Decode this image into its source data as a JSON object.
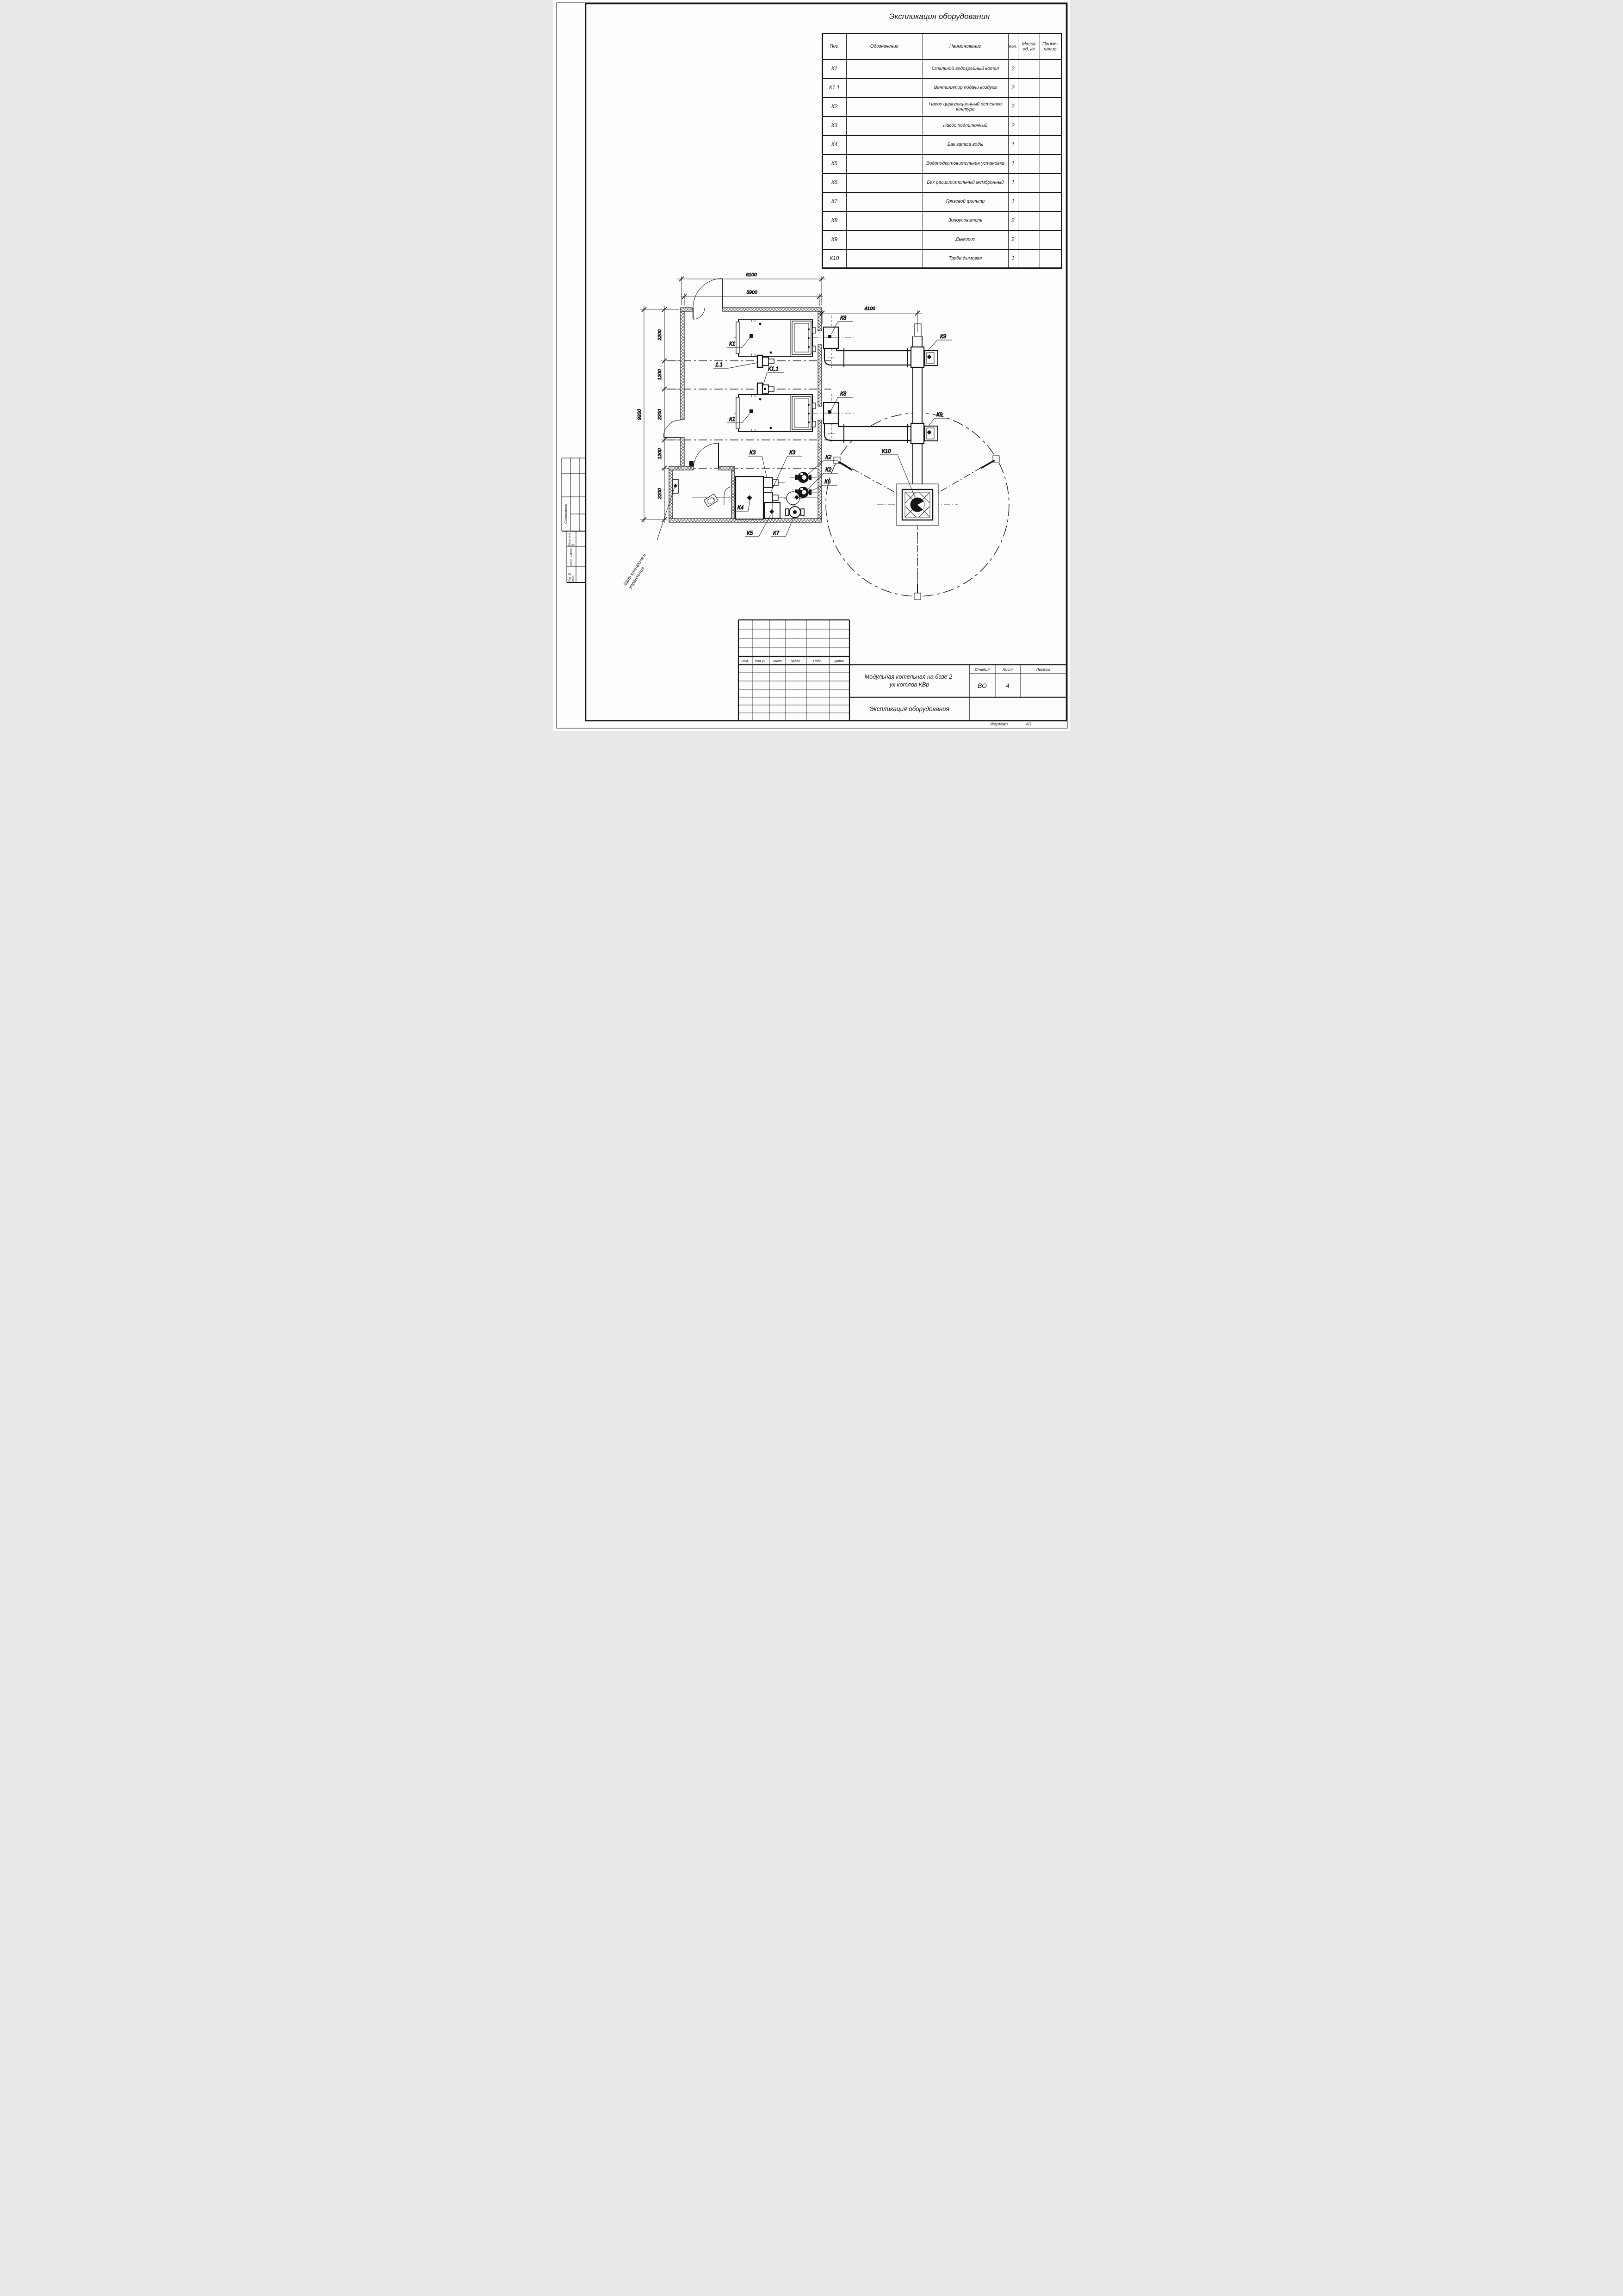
{
  "sheet": {
    "format_label": "Формат",
    "format_value": "А3"
  },
  "spec_table": {
    "title": "Экспликация оборудования",
    "headers": {
      "pos": "Поз.",
      "designation": "Обозначение",
      "name": "Наименование",
      "qty": "Кол.",
      "mass": "Масса ед, кг",
      "note": "Приме- чание"
    },
    "rows": [
      {
        "pos": "К1",
        "name": "Стальной водогрейный котёл",
        "qty": "2"
      },
      {
        "pos": "К1.1",
        "name": "Вентилятор подачи воздуха",
        "qty": "2"
      },
      {
        "pos": "К2",
        "name": "Насос циркуляционный сетевого контура",
        "qty": "2"
      },
      {
        "pos": "К3",
        "name": "Насос подпиточный",
        "qty": "2"
      },
      {
        "pos": "К4",
        "name": "Бак запаса воды",
        "qty": "1"
      },
      {
        "pos": "К5",
        "name": "Водоподготовительная установка",
        "qty": "1"
      },
      {
        "pos": "К6",
        "name": "Бак расширительный мембранный",
        "qty": "1"
      },
      {
        "pos": "К7",
        "name": "Грязевой фильтр",
        "qty": "1"
      },
      {
        "pos": "К8",
        "name": "Золоуловитель",
        "qty": "2"
      },
      {
        "pos": "К9",
        "name": "Дымосос",
        "qty": "2"
      },
      {
        "pos": "К10",
        "name": "Труба дымовая",
        "qty": "1"
      }
    ]
  },
  "title_block": {
    "columns": [
      "Изм.",
      "Кол.уч.",
      "Лист",
      "№док.",
      "Подп.",
      "Дата"
    ],
    "project_name": "Модульная котельная на базе 2-ух котлов КВр",
    "stage_label": "Стадия",
    "sheet_label": "Лист",
    "sheets_label": "Листов",
    "stage_value": "ВО",
    "sheet_value": "4",
    "sheets_value": "",
    "doc_title": "Экспликация оборудования"
  },
  "side_labels": {
    "approved": "Согласовано",
    "replace_inv": "Взам. инв. №",
    "sign_date": "Подп. и дата",
    "inv_orig": "Инв. № подл."
  },
  "plan": {
    "callouts": {
      "k1": "К1",
      "fan": "1.1",
      "k11": "К1.1",
      "k2": "К2",
      "k3": "К3",
      "k4": "К4",
      "k5": "К5",
      "k6": "К6",
      "k7": "К7",
      "k8": "К8",
      "k9": "К9",
      "k10": "К10"
    },
    "panel_label": "Щит контроля и управления",
    "dims": {
      "w_total": "6100",
      "w_inner": "5900",
      "flue": "4100",
      "h_total": "9200",
      "seg_a": "2200",
      "seg_b": "1200"
    }
  }
}
